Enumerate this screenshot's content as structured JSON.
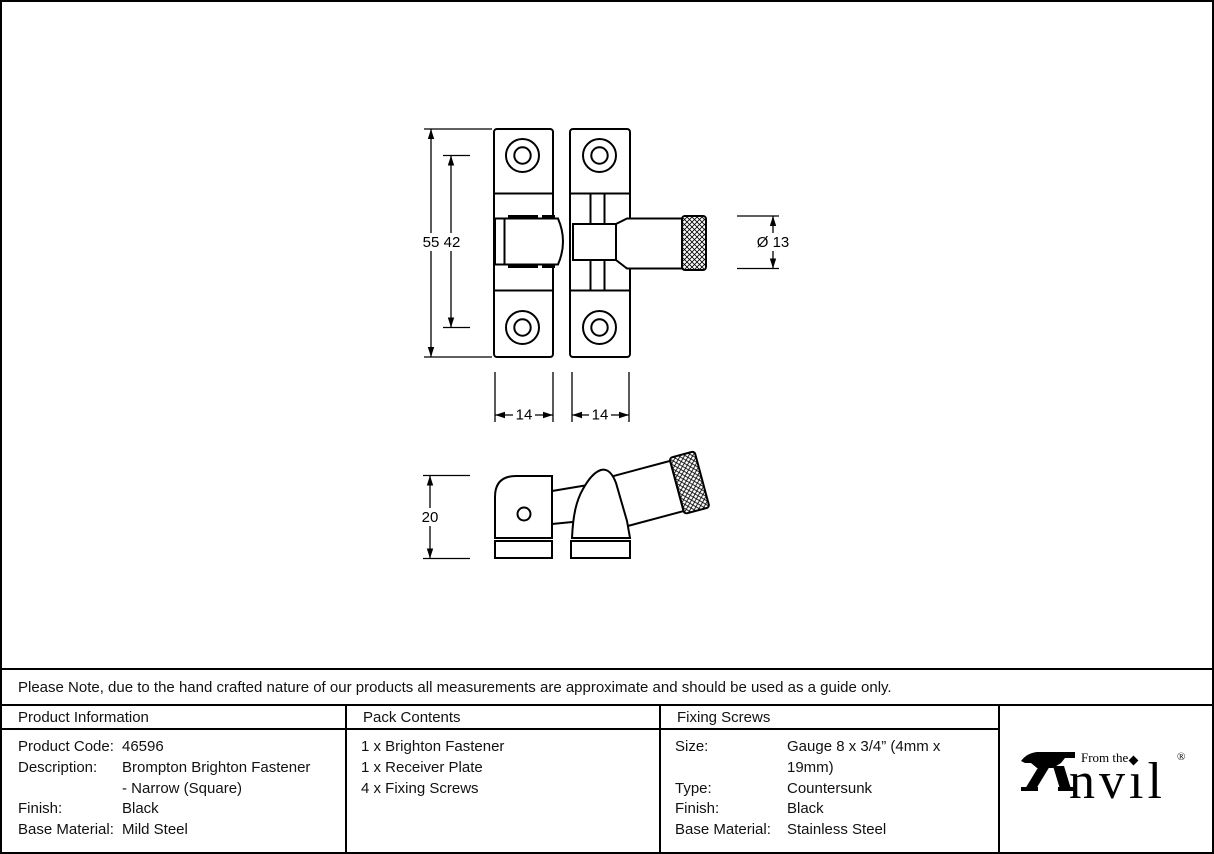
{
  "note": "Please Note, due to the hand crafted nature of our products all measurements are approximate and should be used as a guide only.",
  "drawing": {
    "front_view": {
      "dims": {
        "overall_height": "55",
        "hole_spacing": "42",
        "knob_diameter": "Ø 13",
        "left_plate_width": "14",
        "right_plate_width": "14"
      }
    },
    "side_view": {
      "dims": {
        "depth": "20"
      }
    }
  },
  "table": {
    "product_info": {
      "title": "Product Information",
      "rows": [
        {
          "label": "Product Code:",
          "value": "46596"
        },
        {
          "label": "Description:",
          "value": "Brompton Brighton Fastener"
        },
        {
          "label": "",
          "value": "- Narrow (Square)"
        },
        {
          "label": "Finish:",
          "value": "Black"
        },
        {
          "label": "Base Material:",
          "value": "Mild Steel"
        }
      ]
    },
    "pack_contents": {
      "title": "Pack Contents",
      "items": [
        "1 x Brighton Fastener",
        "1 x Receiver Plate",
        "4 x Fixing Screws"
      ]
    },
    "fixing_screws": {
      "title": "Fixing Screws",
      "rows": [
        {
          "label": "Size:",
          "value": "Gauge 8 x 3/4” (4mm x 19mm)"
        },
        {
          "label": "Type:",
          "value": "Countersunk"
        },
        {
          "label": "Finish:",
          "value": "Black"
        },
        {
          "label": "Base Material:",
          "value": "Stainless Steel"
        }
      ]
    }
  },
  "brand": {
    "name": "Anvil",
    "prefix": "From the",
    "name_rest_display": "nvıl",
    "registered": "®"
  },
  "colors": {
    "ink": "#000000",
    "paper": "#ffffff"
  }
}
